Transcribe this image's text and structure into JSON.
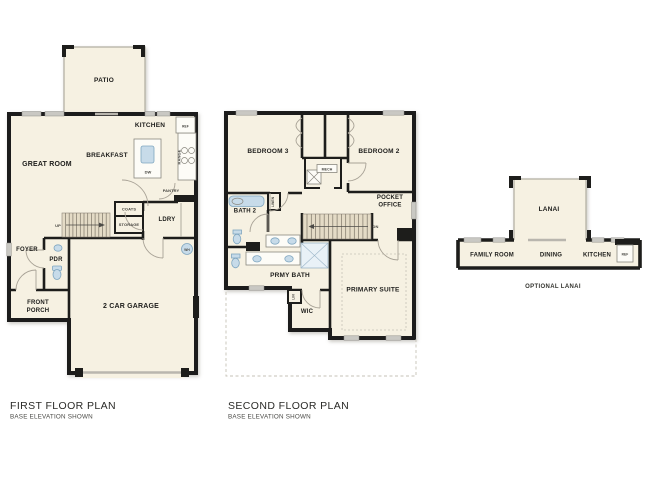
{
  "colors": {
    "wall": "#1d1d1b",
    "floor": "#f6f1e2",
    "window": "#c9c8c3",
    "fixture": "#c7dbe9",
    "fixture_stroke": "#7fa6c0",
    "stairs": "#e4dbc6",
    "door_arc": "#a8a296",
    "dashed": "#c6c2b7",
    "label": "#1d1d1b",
    "small_label": "#45443f"
  },
  "first_floor": {
    "title": "FIRST FLOOR PLAN",
    "subtitle": "BASE ELEVATION SHOWN",
    "rooms": {
      "patio": "PATIO",
      "kitchen": "KITCHEN",
      "breakfast": "BREAKFAST",
      "great_room": "GREAT ROOM",
      "ldry": "LDRY",
      "foyer": "FOYER",
      "pdr": "PDR",
      "front_porch_line1": "FRONT",
      "front_porch_line2": "PORCH",
      "garage": "2 CAR GARAGE"
    },
    "fixtures": {
      "ref": "REF",
      "dw": "DW",
      "range": "RANGE",
      "pantry": "PANTRY",
      "coats": "COATS",
      "storage": "STORAGE",
      "up": "UP",
      "wh": "WH"
    }
  },
  "second_floor": {
    "title": "SECOND FLOOR PLAN",
    "subtitle": "BASE ELEVATION SHOWN",
    "rooms": {
      "bedroom3": "BEDROOM 3",
      "bedroom2": "BEDROOM 2",
      "bath2": "BATH 2",
      "pocket_office_line1": "POCKET",
      "pocket_office_line2": "OFFICE",
      "prmy_bath": "PRMY BATH",
      "primary_suite": "PRIMARY SUITE",
      "wic": "WIC"
    },
    "fixtures": {
      "mech": "MECH",
      "linen": "LINEN",
      "lin": "LIN",
      "dn": "DN"
    }
  },
  "lanai_option": {
    "caption": "OPTIONAL LANAI",
    "rooms": {
      "lanai": "LANAI",
      "family_room": "FAMILY ROOM",
      "dining": "DINING",
      "kitchen": "KITCHEN"
    },
    "fixtures": {
      "ref": "REF"
    }
  }
}
